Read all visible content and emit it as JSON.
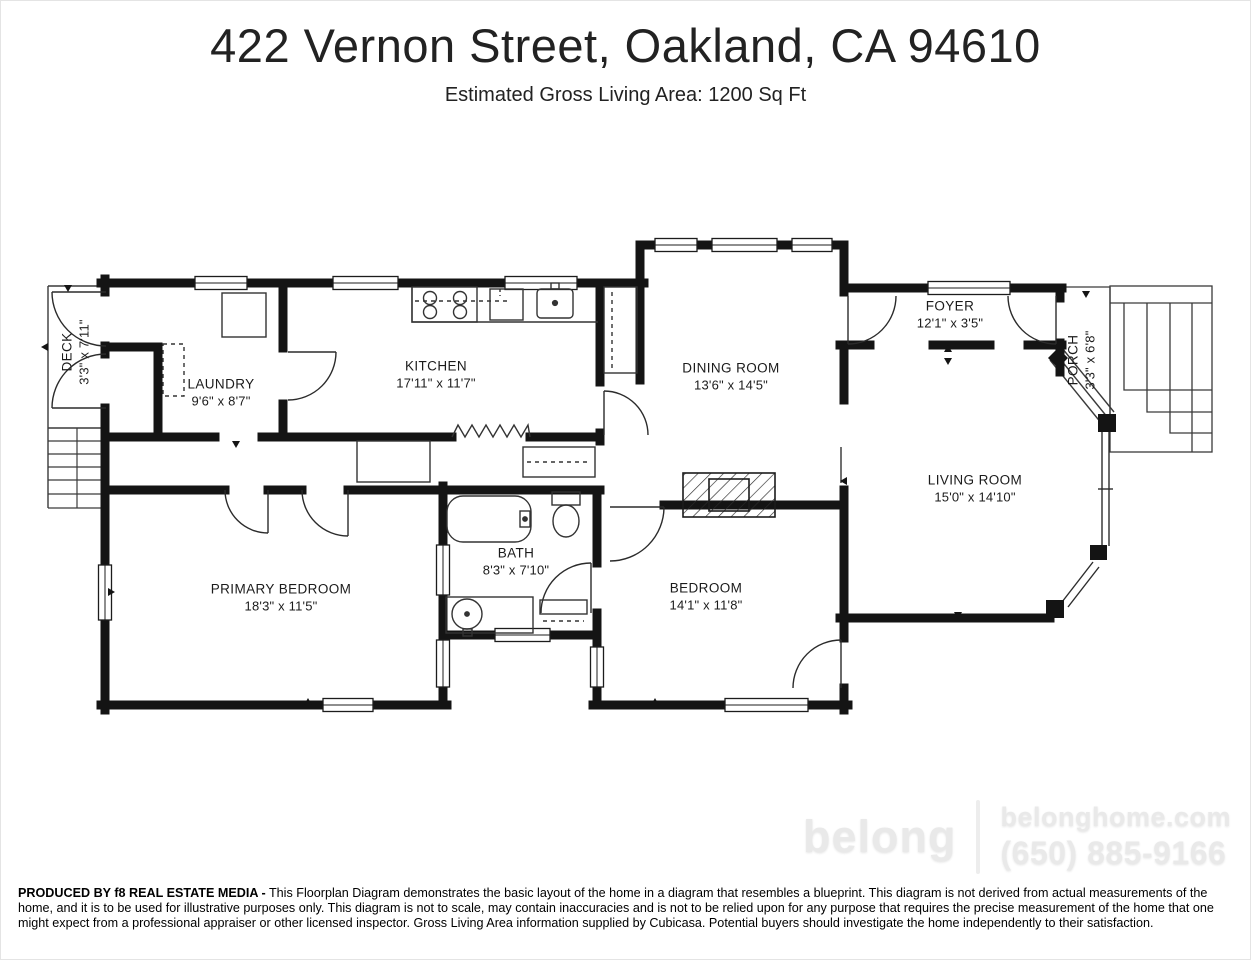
{
  "header": {
    "title": "422 Vernon Street, Oakland, CA  94610",
    "subtitle": "Estimated Gross Living Area: 1200 Sq Ft"
  },
  "rooms": {
    "deck": {
      "name": "DECK",
      "dims": "3'3\" x 7'11\""
    },
    "laundry": {
      "name": "LAUNDRY",
      "dims": "9'6\" x 8'7\""
    },
    "kitchen": {
      "name": "KITCHEN",
      "dims": "17'11\" x 11'7\""
    },
    "dining": {
      "name": "DINING ROOM",
      "dims": "13'6\" x 14'5\""
    },
    "foyer": {
      "name": "FOYER",
      "dims": "12'1\" x 3'5\""
    },
    "porch": {
      "name": "PORCH",
      "dims": "3'3\" x 6'8\""
    },
    "living": {
      "name": "LIVING ROOM",
      "dims": "15'0\" x 14'10\""
    },
    "primary": {
      "name": "PRIMARY BEDROOM",
      "dims": "18'3\" x 11'5\""
    },
    "bath": {
      "name": "BATH",
      "dims": "8'3\" x 7'10\""
    },
    "bedroom": {
      "name": "BEDROOM",
      "dims": "14'1\" x 11'8\""
    }
  },
  "watermark": {
    "brand": "belong",
    "website": "belonghome.com",
    "phone": "(650) 885-9166"
  },
  "disclaimer": {
    "lead": "PRODUCED BY f8 REAL ESTATE MEDIA -",
    "body": " This Floorplan Diagram demonstrates the basic layout of the home in a diagram that resembles a blueprint. This diagram is not derived from actual measurements of the home, and it is to be used for illustrative purposes only. This diagram is not to scale, may contain inaccuracies and is not to be relied upon for any purpose that requires the precise measurement of the home that one might expect from a professional appraiser or other licensed inspector. Gross Living Area information supplied by Cubicasa. Potential buyers should investigate the home independently to their satisfaction."
  }
}
